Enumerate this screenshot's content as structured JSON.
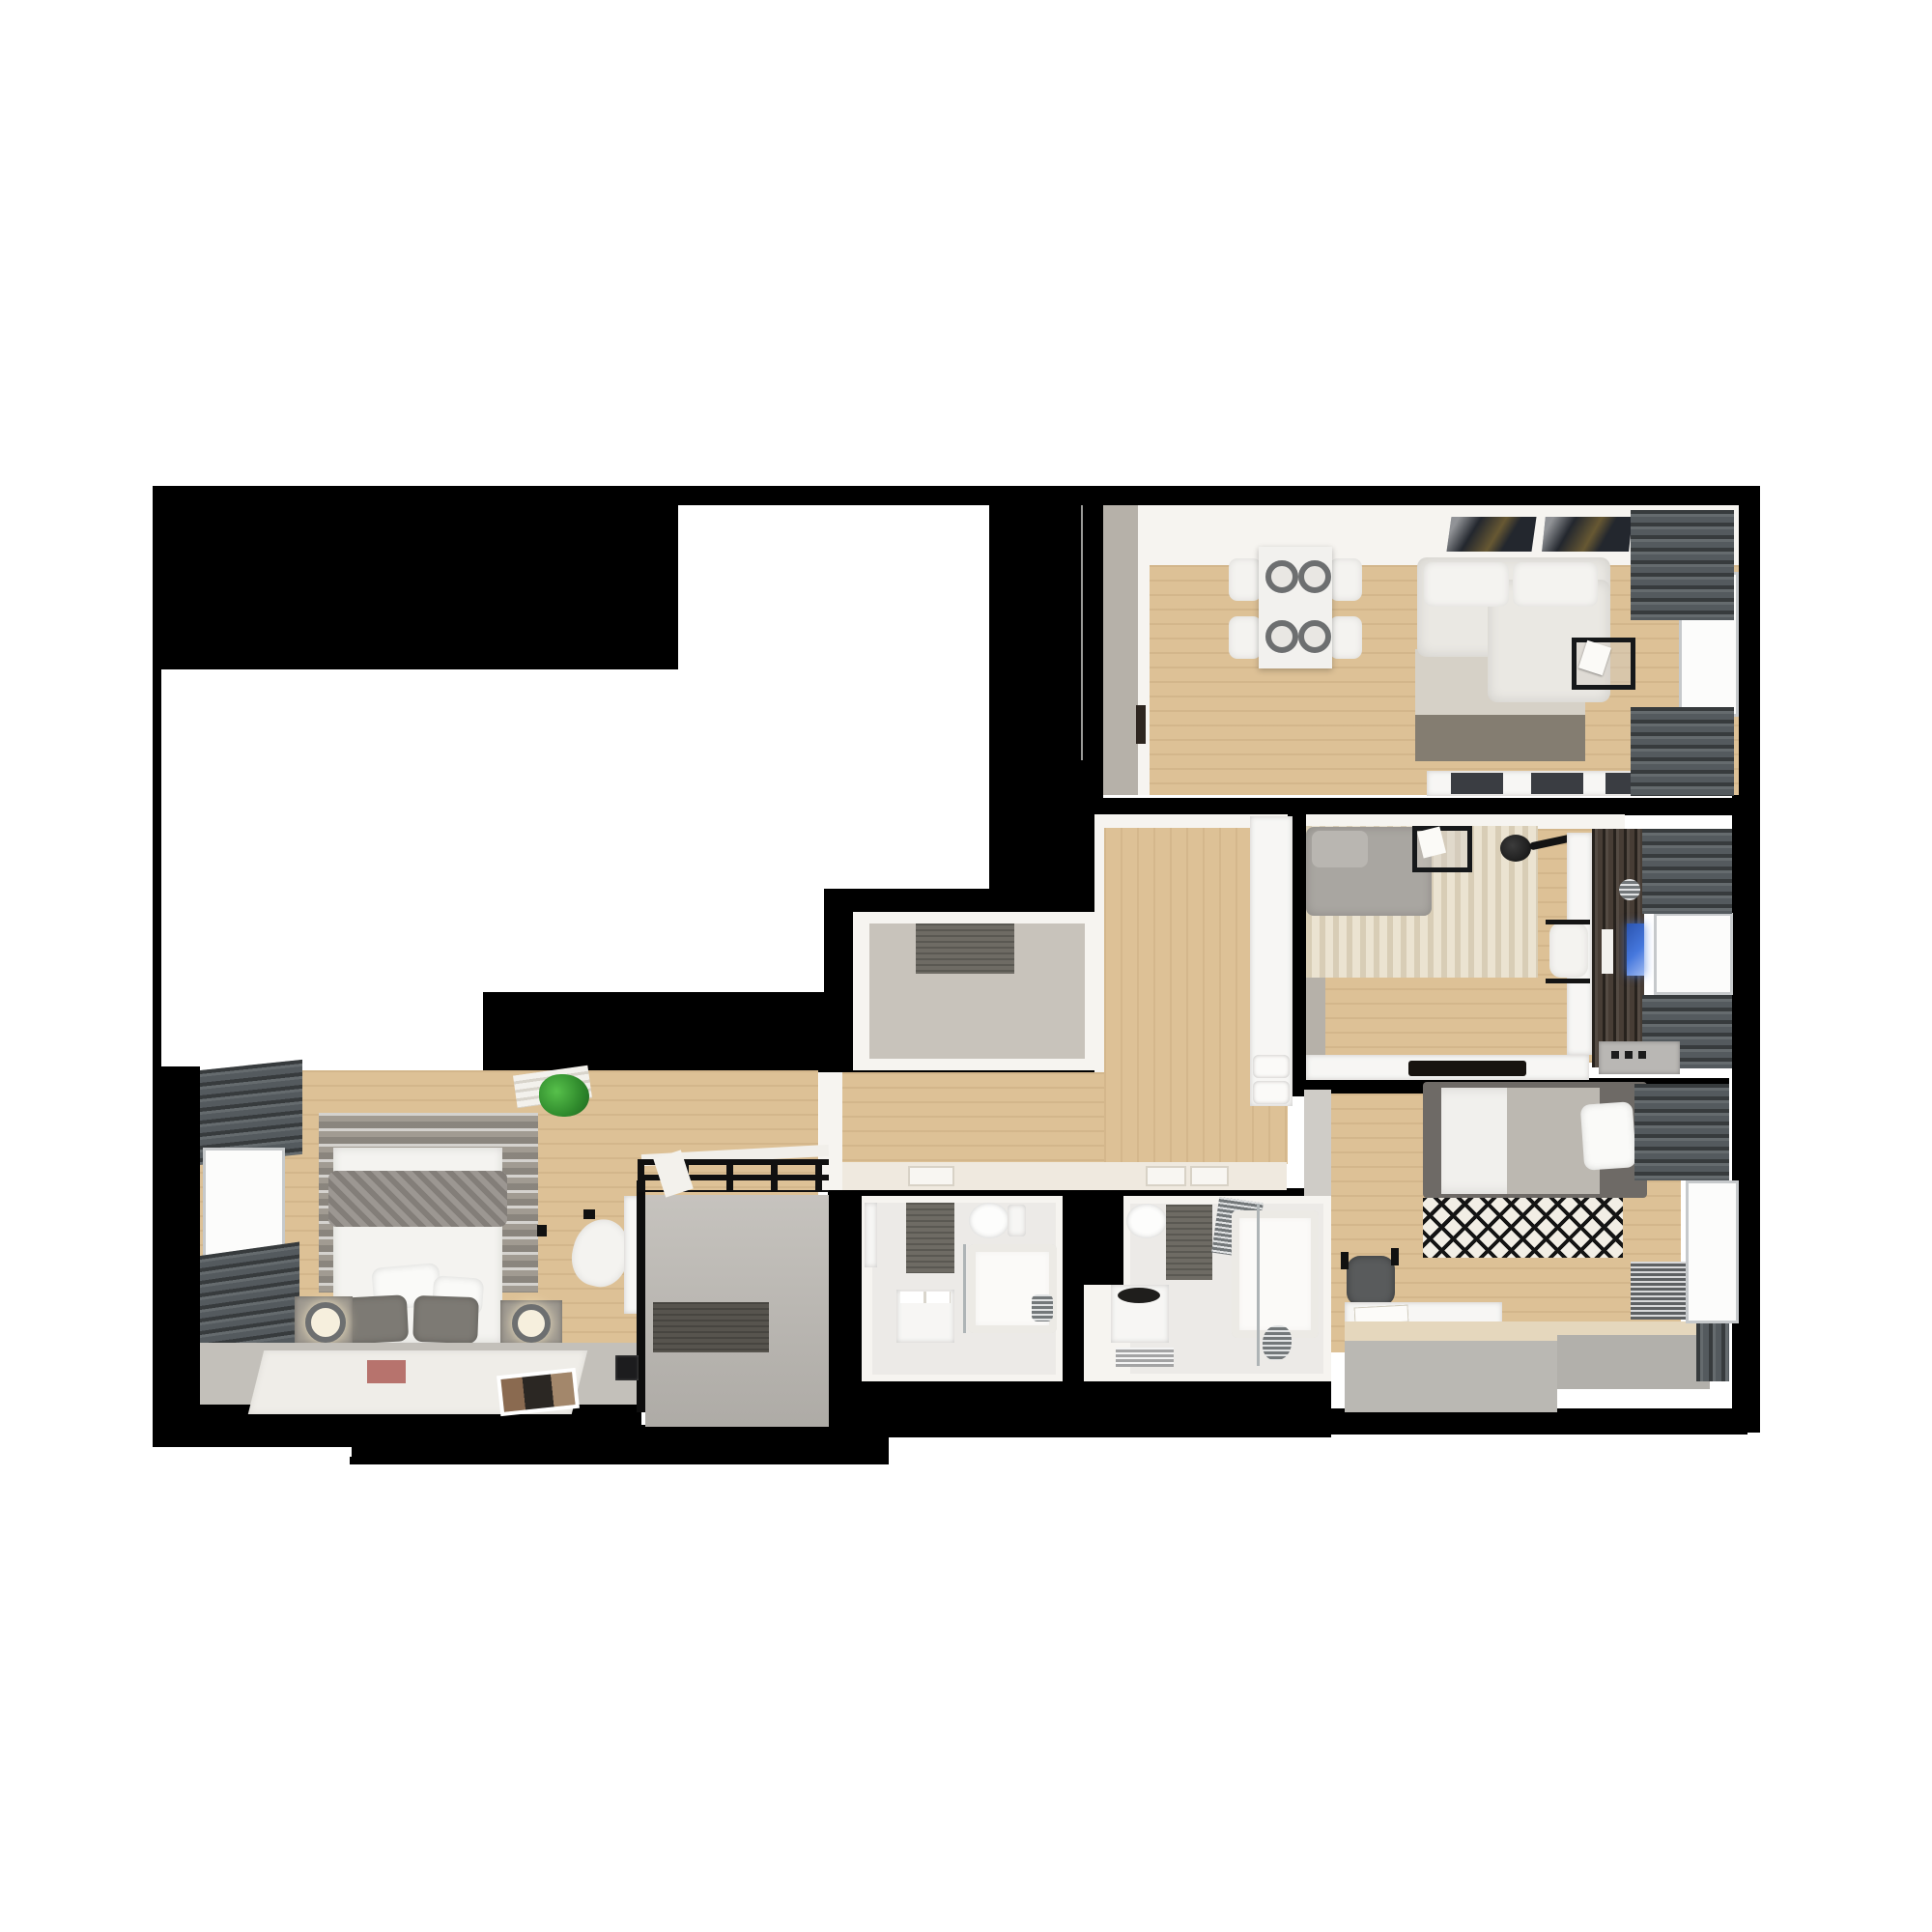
{
  "scene": {
    "type": "3d-floorplan-render",
    "description": "Top-down 3D render of a furnished apartment floor plan on a black cut-out silhouette over a white canvas",
    "rooms": [
      {
        "id": "living-room",
        "contents": [
          "dining-table-4-chairs",
          "corner-sofa",
          "two-tone-rug",
          "wall-art-pair",
          "tv-sideboard",
          "windows-with-curtains"
        ]
      },
      {
        "id": "study-room",
        "contents": [
          "gray-sofa",
          "chevron-rug",
          "floor-lamp",
          "side-table",
          "desk-with-chair",
          "dark-tv-wardrobe",
          "monitor",
          "window-with-curtains"
        ]
      },
      {
        "id": "bedroom-right",
        "contents": [
          "double-bed",
          "diamond-rug",
          "desk",
          "office-chair",
          "window-bench-platform",
          "radiator",
          "window-with-curtains"
        ]
      },
      {
        "id": "bedroom-left",
        "contents": [
          "double-bed",
          "striped-rug",
          "nightstands-with-lamps",
          "plant-shelf",
          "vanity-chair",
          "floor-runner",
          "windows-with-curtains"
        ]
      },
      {
        "id": "kitchen-hall",
        "contents": [
          "tall-cabinet-column",
          "oven-stack",
          "open-door"
        ]
      },
      {
        "id": "wardrobe-room",
        "contents": [
          "gray-rug"
        ]
      },
      {
        "id": "corridor",
        "contents": [
          "bathroom-door-outlines"
        ]
      },
      {
        "id": "entry-hall",
        "contents": [
          "black-coat-rack-grid",
          "door-mat",
          "mirror-niche",
          "intercom-panel"
        ]
      },
      {
        "id": "bathroom-1",
        "contents": [
          "toilet",
          "washbasin-cabinet",
          "bathtub",
          "dark-mat",
          "door"
        ]
      },
      {
        "id": "bathroom-2",
        "contents": [
          "toilet",
          "vessel-sink-cabinet",
          "bathtub-shower",
          "towel-radiator",
          "dark-mat",
          "floor-grate"
        ]
      }
    ]
  },
  "colors": {
    "canvas": "#ffffff",
    "mask": "#000000",
    "wood": "#ddc196",
    "floorGray": "#c8c3bb",
    "tile": "#eceae7",
    "entryFloor": "#b7b4af",
    "wall": "#f6f4f0",
    "wallFace": "#b6b1a9",
    "curtain": "#545a5e",
    "window": "#fcfcfb",
    "windowFrame": "#c6c9cb",
    "sofaWhite": "#eae8e3",
    "rugLight": "#d6d1c7",
    "rugDark": "#847d71",
    "rugChevron": "#ebe3d1",
    "sofaGray": "#a9a6a1",
    "darkWood": "#473d35",
    "tvBlue": "#4577dd",
    "bedQuilt": "#8e8983",
    "headboardStripes": "#a19b92",
    "diamondBg": "#f2eee5",
    "diamondInk": "#141414",
    "darkMat": "#6e6b64",
    "chrome": "#9aa0a3",
    "plant": "#3f9c35",
    "artDark": "#23272e",
    "doorGray": "#8a8a88",
    "bedFrame": "#6e6a66"
  }
}
